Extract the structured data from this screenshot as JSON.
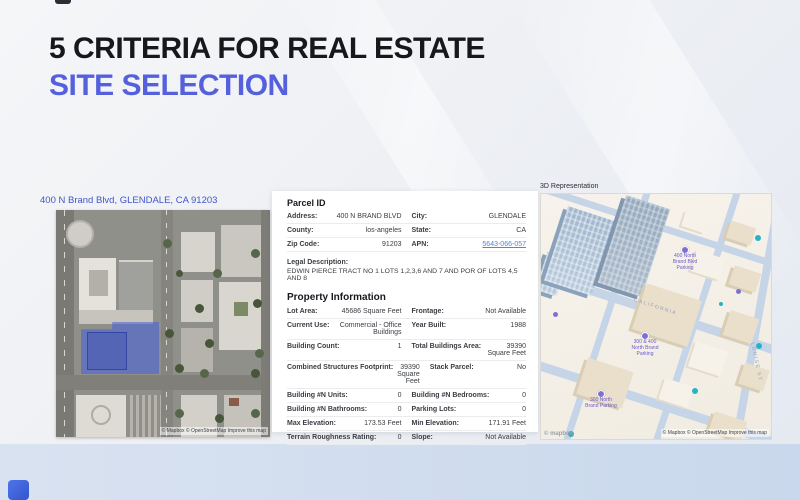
{
  "slide": {
    "title_line1": "5 CRITERIA FOR REAL ESTATE",
    "title_line2": "SITE SELECTION"
  },
  "satellite_panel": {
    "address": "400 N Brand Blvd, GLENDALE, CA 91203",
    "attribution": "© Mapbox © OpenStreetMap Improve this map"
  },
  "parcel_panel": {
    "header": "Parcel ID",
    "rows": [
      {
        "l1": "Address:",
        "v1": "400 N BRAND BLVD",
        "l2": "City:",
        "v2": "GLENDALE"
      },
      {
        "l1": "County:",
        "v1": "los-angeles",
        "l2": "State:",
        "v2": "CA"
      },
      {
        "l1": "Zip Code:",
        "v1": "91203",
        "l2": "APN:",
        "v2": "5643-066-057"
      }
    ],
    "legal_label": "Legal Description:",
    "legal_text": "EDWIN PIERCE TRACT NO 1 LOTS 1,2,3,6 AND 7 AND POR OF LOTS 4,5 AND 8",
    "property_header": "Property Information",
    "property_rows": [
      {
        "l1": "Lot Area:",
        "v1": "45686 Square Feet",
        "l2": "Frontage:",
        "v2": "Not Available"
      },
      {
        "l1": "Current Use:",
        "v1": "Commercial - Office Buildings",
        "l2": "Year Built:",
        "v2": "1988"
      },
      {
        "l1": "Building Count:",
        "v1": "1",
        "l2": "Total Buildings Area:",
        "v2": "39390 Square Feet"
      },
      {
        "l1": "Combined Structures Footprint:",
        "v1": "39390 Square Feet",
        "l2": "Stack Parcel:",
        "v2": "No"
      },
      {
        "l1": "Building #N Units:",
        "v1": "0",
        "l2": "Building #N Bedrooms:",
        "v2": "0"
      },
      {
        "l1": "Building #N Bathrooms:",
        "v1": "0",
        "l2": "Parking Lots:",
        "v2": "0"
      },
      {
        "l1": "Max Elevation:",
        "v1": "173.53 Feet",
        "l2": "Min Elevation:",
        "v2": "171.91 Feet"
      },
      {
        "l1": "Terrain Roughness Rating:",
        "v1": "0",
        "l2": "Slope:",
        "v2": "Not Available"
      }
    ]
  },
  "three_d_panel": {
    "label": "3D Representation",
    "markers": [
      {
        "label": "400 North Brand Blvd Parking"
      },
      {
        "label": "300 & 400 North Brand Parking"
      },
      {
        "label": "300 North Brand Parking"
      }
    ],
    "street_labels": {
      "california": "CALIFORNIA",
      "louise": "LOUISE ST"
    },
    "logo": "© mapbox",
    "attribution": "© Mapbox © OpenStreetMap Improve this map"
  },
  "colors": {
    "accent": "#5560dd",
    "parcel_highlight": "#435fde",
    "link": "#4f88d6"
  }
}
